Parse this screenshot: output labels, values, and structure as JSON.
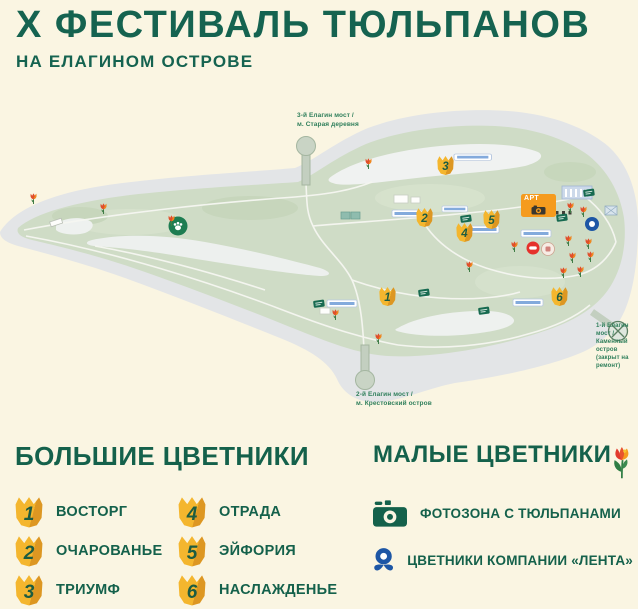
{
  "title": "Х ФЕСТИВАЛЬ ТЮЛЬПАНОВ",
  "subtitle": "НА ЕЛАГИНОМ ОСТРОВЕ",
  "map": {
    "art_zone_label": "АРТ",
    "bridges": {
      "third": {
        "line1": "3-й Елагин мост /",
        "line2": "м. Старая деревня"
      },
      "second": {
        "line1": "2-й Елагин мост /",
        "line2": "м. Крестовский остров"
      },
      "first": {
        "line1": "1-й Елагин мост /",
        "line2": "Каменный остров",
        "line3": "(закрыт на ремонт)"
      }
    },
    "markers": [
      {
        "num": "1"
      },
      {
        "num": "2"
      },
      {
        "num": "3"
      },
      {
        "num": "4"
      },
      {
        "num": "5"
      },
      {
        "num": "6"
      }
    ]
  },
  "legend_large": {
    "heading": "БОЛЬШИЕ ЦВЕТНИКИ",
    "items": [
      {
        "num": "1",
        "label": "ВОСТОРГ"
      },
      {
        "num": "2",
        "label": "ОЧАРОВАНЬЕ"
      },
      {
        "num": "3",
        "label": "ТРИУМФ"
      },
      {
        "num": "4",
        "label": "ОТРАДА"
      },
      {
        "num": "5",
        "label": "ЭЙФОРИЯ"
      },
      {
        "num": "6",
        "label": "НАСЛАЖДЕНЬЕ"
      }
    ]
  },
  "legend_small": {
    "heading": "МАЛЫЕ ЦВЕТНИКИ",
    "items": [
      {
        "icon": "camera-icon",
        "label": "ФОТОЗОНА С ТЮЛЬПАНАМИ"
      },
      {
        "icon": "lenta-flower-icon",
        "label": "ЦВЕТНИКИ КОМПАНИИ «ЛЕНТА»"
      }
    ]
  },
  "colors": {
    "background": "#faf5e2",
    "title_green": "#156350",
    "island_green": "#cfdcc6",
    "water_gray": "#e3e5e7",
    "marker_yellow": "#f4b62e",
    "art_orange": "#f59b1e",
    "lenta_blue": "#1d56a5",
    "lenta_red": "#e5312b"
  }
}
